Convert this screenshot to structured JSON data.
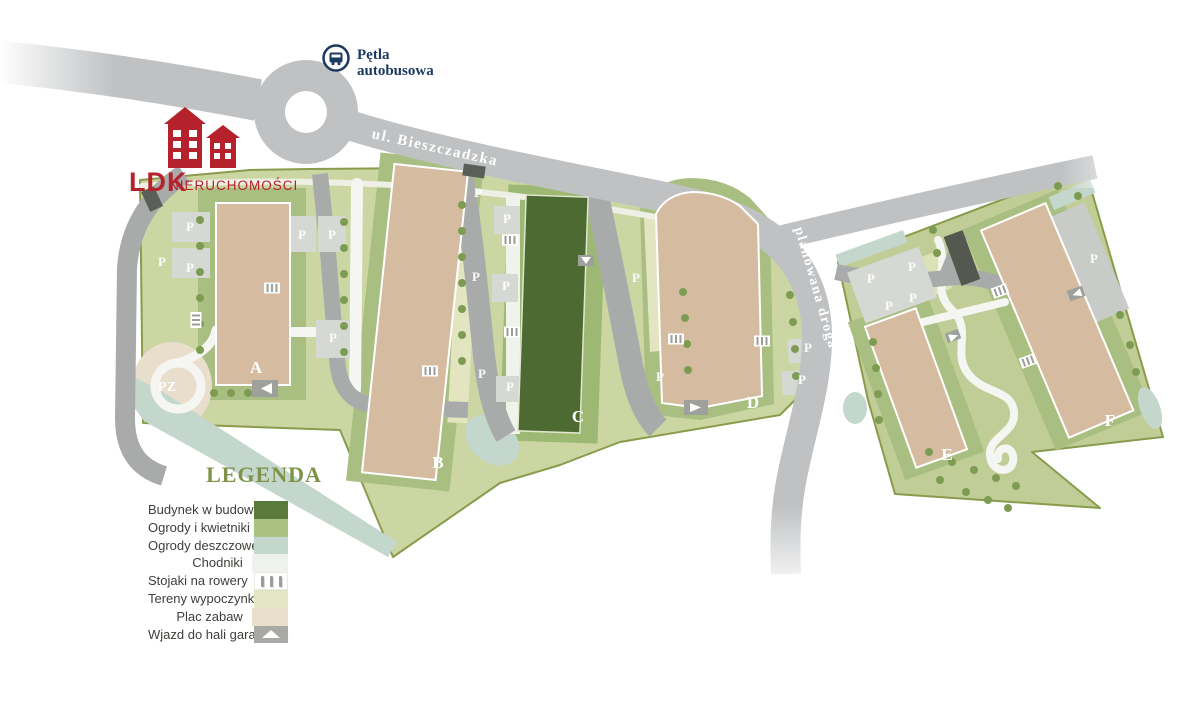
{
  "branding": {
    "name": "LDK",
    "suffix": "NIERUCHOMOŚCI",
    "color": "#b5222b"
  },
  "transit": {
    "bus_loop_line1": "Pętla",
    "bus_loop_line2": "autobusowa",
    "color": "#1c3a60"
  },
  "streets": {
    "main": "ul. Bieszczadzka",
    "planned": "planowana droga"
  },
  "buildings": {
    "a": "A",
    "b": "B",
    "c": "C",
    "d": "D",
    "e": "E",
    "f": "F"
  },
  "markers": {
    "parking": "P",
    "playground": "PZ"
  },
  "legend": {
    "title": "LEGENDA",
    "items": [
      {
        "label": "Budynek w budowie",
        "color": "#5a7a3b"
      },
      {
        "label": "Ogrody i kwietniki",
        "color": "#a9c183"
      },
      {
        "label": "Ogrody deszczowe",
        "color": "#c4d7cc"
      },
      {
        "label": "Chodniki",
        "color": "#eef1ec"
      },
      {
        "label": "Stojaki na rowery",
        "color": "#ffffff"
      },
      {
        "label": "Tereny wypoczynkowe",
        "color": "#e4e5c2"
      },
      {
        "label": "Plac zabaw",
        "color": "#eadfcc"
      },
      {
        "label": "Wjazd do hali garażowej",
        "color": "#a7a9a4"
      }
    ]
  },
  "colors": {
    "road": "#bfc1c3",
    "road_internal": "#a9abab",
    "parcel": "#cbd6a2",
    "garden": "#a9bf82",
    "building": "#d5bb9f",
    "building_construction": "#4d6a32",
    "rain_garden": "#c4d7cc",
    "walkway": "#f5f6f2",
    "tree": "#7d9c52",
    "boundary": "#8a9b4c"
  }
}
